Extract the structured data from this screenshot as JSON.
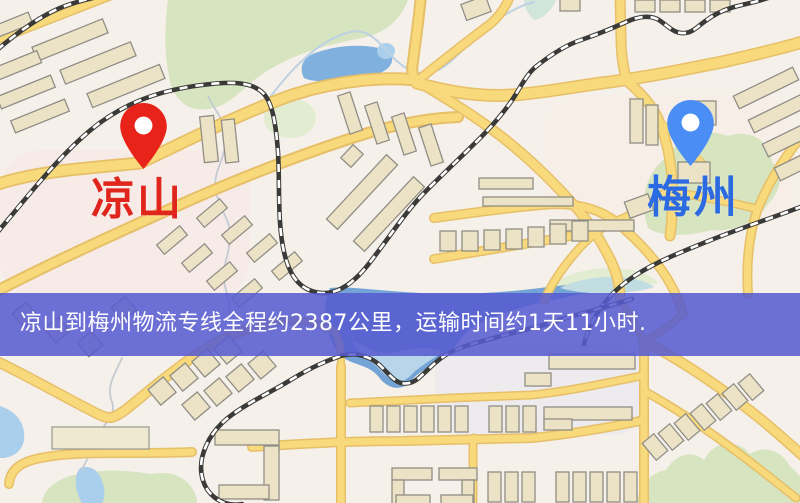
{
  "origin": {
    "name": "凉山",
    "pin_icon": "red-map-pin"
  },
  "destination": {
    "name": "梅州",
    "pin_icon": "blue-map-pin"
  },
  "banner": {
    "text": "凉山到梅州物流专线全程约2387公里，运输时间约1天11小时.",
    "distance_km": "2387",
    "duration_text": "1天11小时"
  },
  "palette": {
    "map_bg": "#f6f0ea",
    "road": "#f8da7c",
    "road_casing": "#e6bf68",
    "water": "#7fb0de",
    "green": "#d6e4c0",
    "building": "#ece3c7",
    "building_stroke": "#908e86",
    "rail": "#3a3a38",
    "banner_color": "#575cd0",
    "banner_text_color": "#ffffff",
    "origin_label_color": "#e0251c",
    "origin_pin_color": "#e8231a",
    "destination_label_color": "#2b6ae0",
    "destination_pin_color": "#4a8ef5"
  }
}
